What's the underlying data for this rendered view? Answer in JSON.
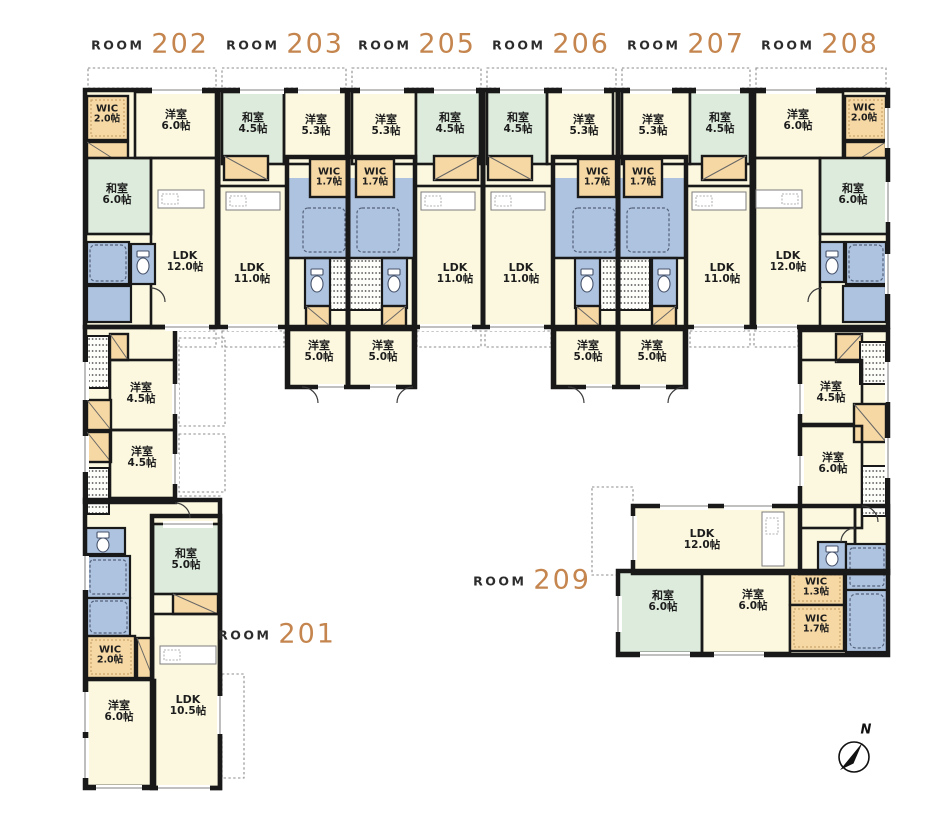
{
  "page": {
    "background": "#ffffff",
    "kind": "apartment-floor-plan"
  },
  "palette": {
    "wall": "#191919",
    "western_room": "#FBF8DF",
    "tatami_room": "#DCEBDB",
    "sanitary": "#AEC3DF",
    "storage": "#F6D8A4",
    "room_number_accent": "#C5854E"
  },
  "compass": {
    "label": "N"
  },
  "unit_headers": [
    {
      "prefix": "ROOM",
      "number": "202"
    },
    {
      "prefix": "ROOM",
      "number": "203"
    },
    {
      "prefix": "ROOM",
      "number": "205"
    },
    {
      "prefix": "ROOM",
      "number": "206"
    },
    {
      "prefix": "ROOM",
      "number": "207"
    },
    {
      "prefix": "ROOM",
      "number": "208"
    },
    {
      "prefix": "ROOM",
      "number": "201"
    },
    {
      "prefix": "ROOM",
      "number": "209"
    }
  ],
  "rooms": [
    {
      "unit": "202",
      "name": "WIC",
      "size": "2.0帖"
    },
    {
      "unit": "202",
      "name": "洋室",
      "size": "6.0帖"
    },
    {
      "unit": "202",
      "name": "和室",
      "size": "6.0帖"
    },
    {
      "unit": "202",
      "name": "LDK",
      "size": "12.0帖"
    },
    {
      "unit": "203",
      "name": "和室",
      "size": "4.5帖"
    },
    {
      "unit": "203",
      "name": "洋室",
      "size": "5.3帖"
    },
    {
      "unit": "203",
      "name": "WIC",
      "size": "1.7帖"
    },
    {
      "unit": "203",
      "name": "LDK",
      "size": "11.0帖"
    },
    {
      "unit": "203",
      "name": "洋室",
      "size": "5.0帖"
    },
    {
      "unit": "205",
      "name": "洋室",
      "size": "5.3帖"
    },
    {
      "unit": "205",
      "name": "和室",
      "size": "4.5帖"
    },
    {
      "unit": "205",
      "name": "WIC",
      "size": "1.7帖"
    },
    {
      "unit": "205",
      "name": "LDK",
      "size": "11.0帖"
    },
    {
      "unit": "205",
      "name": "洋室",
      "size": "5.0帖"
    },
    {
      "unit": "206",
      "name": "和室",
      "size": "4.5帖"
    },
    {
      "unit": "206",
      "name": "洋室",
      "size": "5.3帖"
    },
    {
      "unit": "206",
      "name": "WIC",
      "size": "1.7帖"
    },
    {
      "unit": "206",
      "name": "LDK",
      "size": "11.0帖"
    },
    {
      "unit": "206",
      "name": "洋室",
      "size": "5.0帖"
    },
    {
      "unit": "207",
      "name": "洋室",
      "size": "5.3帖"
    },
    {
      "unit": "207",
      "name": "和室",
      "size": "4.5帖"
    },
    {
      "unit": "207",
      "name": "WIC",
      "size": "1.7帖"
    },
    {
      "unit": "207",
      "name": "LDK",
      "size": "11.0帖"
    },
    {
      "unit": "207",
      "name": "洋室",
      "size": "5.0帖"
    },
    {
      "unit": "208",
      "name": "洋室",
      "size": "6.0帖"
    },
    {
      "unit": "208",
      "name": "WIC",
      "size": "2.0帖"
    },
    {
      "unit": "208",
      "name": "和室",
      "size": "6.0帖"
    },
    {
      "unit": "208",
      "name": "LDK",
      "size": "12.0帖"
    },
    {
      "unit": "201",
      "name": "洋室",
      "size": "4.5帖"
    },
    {
      "unit": "201",
      "name": "洋室",
      "size": "4.5帖"
    },
    {
      "unit": "201",
      "name": "和室",
      "size": "5.0帖"
    },
    {
      "unit": "201",
      "name": "WIC",
      "size": "2.0帖"
    },
    {
      "unit": "201",
      "name": "洋室",
      "size": "6.0帖"
    },
    {
      "unit": "201",
      "name": "LDK",
      "size": "10.5帖"
    },
    {
      "unit": "209",
      "name": "洋室",
      "size": "4.5帖"
    },
    {
      "unit": "209",
      "name": "洋室",
      "size": "6.0帖"
    },
    {
      "unit": "209",
      "name": "LDK",
      "size": "12.0帖"
    },
    {
      "unit": "209",
      "name": "和室",
      "size": "6.0帖"
    },
    {
      "unit": "209",
      "name": "洋室",
      "size": "6.0帖"
    },
    {
      "unit": "209",
      "name": "WIC",
      "size": "1.3帖"
    },
    {
      "unit": "209",
      "name": "WIC",
      "size": "1.7帖"
    }
  ]
}
